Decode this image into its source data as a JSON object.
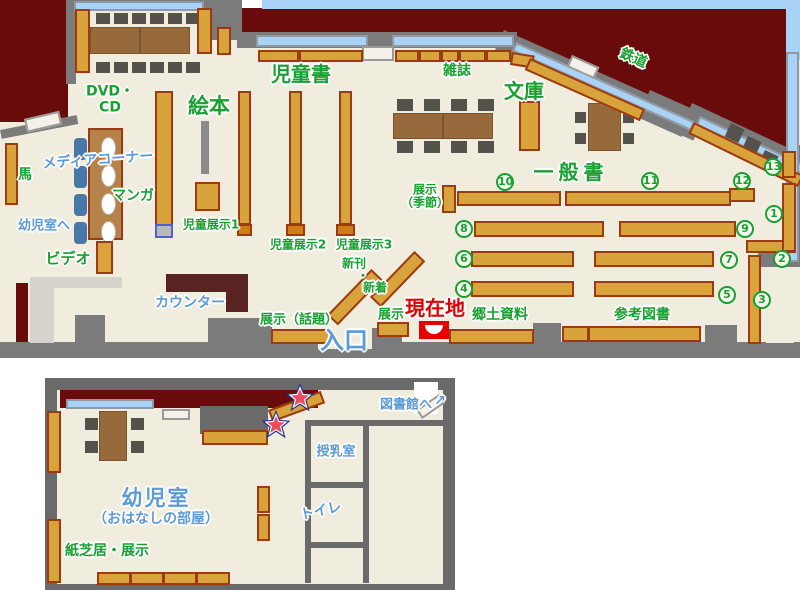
{
  "main_map": {
    "areas": {
      "dvd_cd": "DVD・\nCD",
      "ehon": "絵本",
      "jidosho": "児童書",
      "zasshi": "雑誌",
      "bunko": "文庫",
      "tetsudo": "鉄道",
      "ippansho": "一般書",
      "media_corner": "メディアコーナー",
      "manga": "マンガ",
      "to_yojishitsu": "幼児室へ",
      "video": "ビデオ",
      "uma": "馬",
      "jido_tenji_1": "児童展示1",
      "jido_tenji_2": "児童展示2",
      "jido_tenji_3": "児童展示3",
      "shinkan_line1": "新刊",
      "shinkan_line2": "・",
      "shinkan_line3": "新着",
      "counter": "カウンター",
      "tenji_wadai": "展示（話題）",
      "tenji_kisetsu": "展示\n（季節）",
      "tenji": "展示",
      "iriguchi": "入口",
      "genzaichi": "現在地",
      "kyodo_shiryo": "郷土資料",
      "sanko_tosho": "参考図書"
    },
    "shelf_numbers": [
      "1",
      "2",
      "3",
      "4",
      "5",
      "6",
      "7",
      "8",
      "9",
      "10",
      "11",
      "12",
      "13"
    ]
  },
  "annex_map": {
    "labels": {
      "to_library": "図書館へ",
      "to_library_arrow": "↗",
      "nursing_room": "授乳室",
      "toilet": "トイレ",
      "yojishitsu": "幼児室",
      "ohanashi": "（おはなしの部屋）",
      "kamishibai": "紙芝居・展示"
    }
  },
  "colors": {
    "outside": "#6a0b0b",
    "floor": "#f0edde",
    "wall": "#7b7b7b",
    "shelf": "#d9a33c",
    "window": "#a9d3f6",
    "label_green": "#18a030",
    "label_blue": "#5c9ad8",
    "genzaichi_red": "#e00000"
  }
}
